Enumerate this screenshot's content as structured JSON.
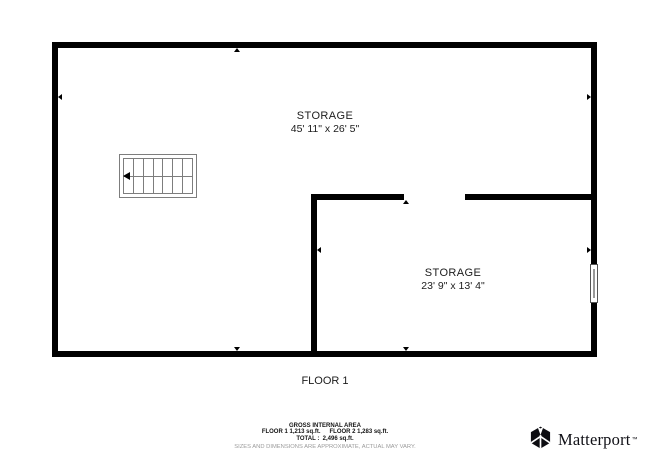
{
  "floor_plan": {
    "rooms": [
      {
        "name": "STORAGE",
        "dimensions": "45' 11\" x 26' 5\""
      },
      {
        "name": "STORAGE",
        "dimensions": "23' 9\" x 13' 4\""
      }
    ],
    "floor_label": "FLOOR 1",
    "symbols": [
      "stairs-icon",
      "window-symbol",
      "dimension-arrow-icons"
    ]
  },
  "footer": {
    "gross_internal_area_title": "GROSS INTERNAL AREA",
    "floor1_area": "FLOOR 1 1,213 sq.ft.",
    "floor2_area": "FLOOR 2 1,283 sq.ft.",
    "total": "TOTAL :  2,496 sq.ft.",
    "disclaimer": "SIZES AND DIMENSIONS ARE APPROXIMATE, ACTUAL MAY VARY."
  },
  "branding": {
    "logo_text": "Matterport",
    "trademark": "™"
  },
  "colors": {
    "wall": "#000000",
    "stairs_line": "#7d7d7d",
    "label_text": "#1c1c1c",
    "disclaimer_text": "#9b9b9b",
    "background": "#ffffff"
  }
}
